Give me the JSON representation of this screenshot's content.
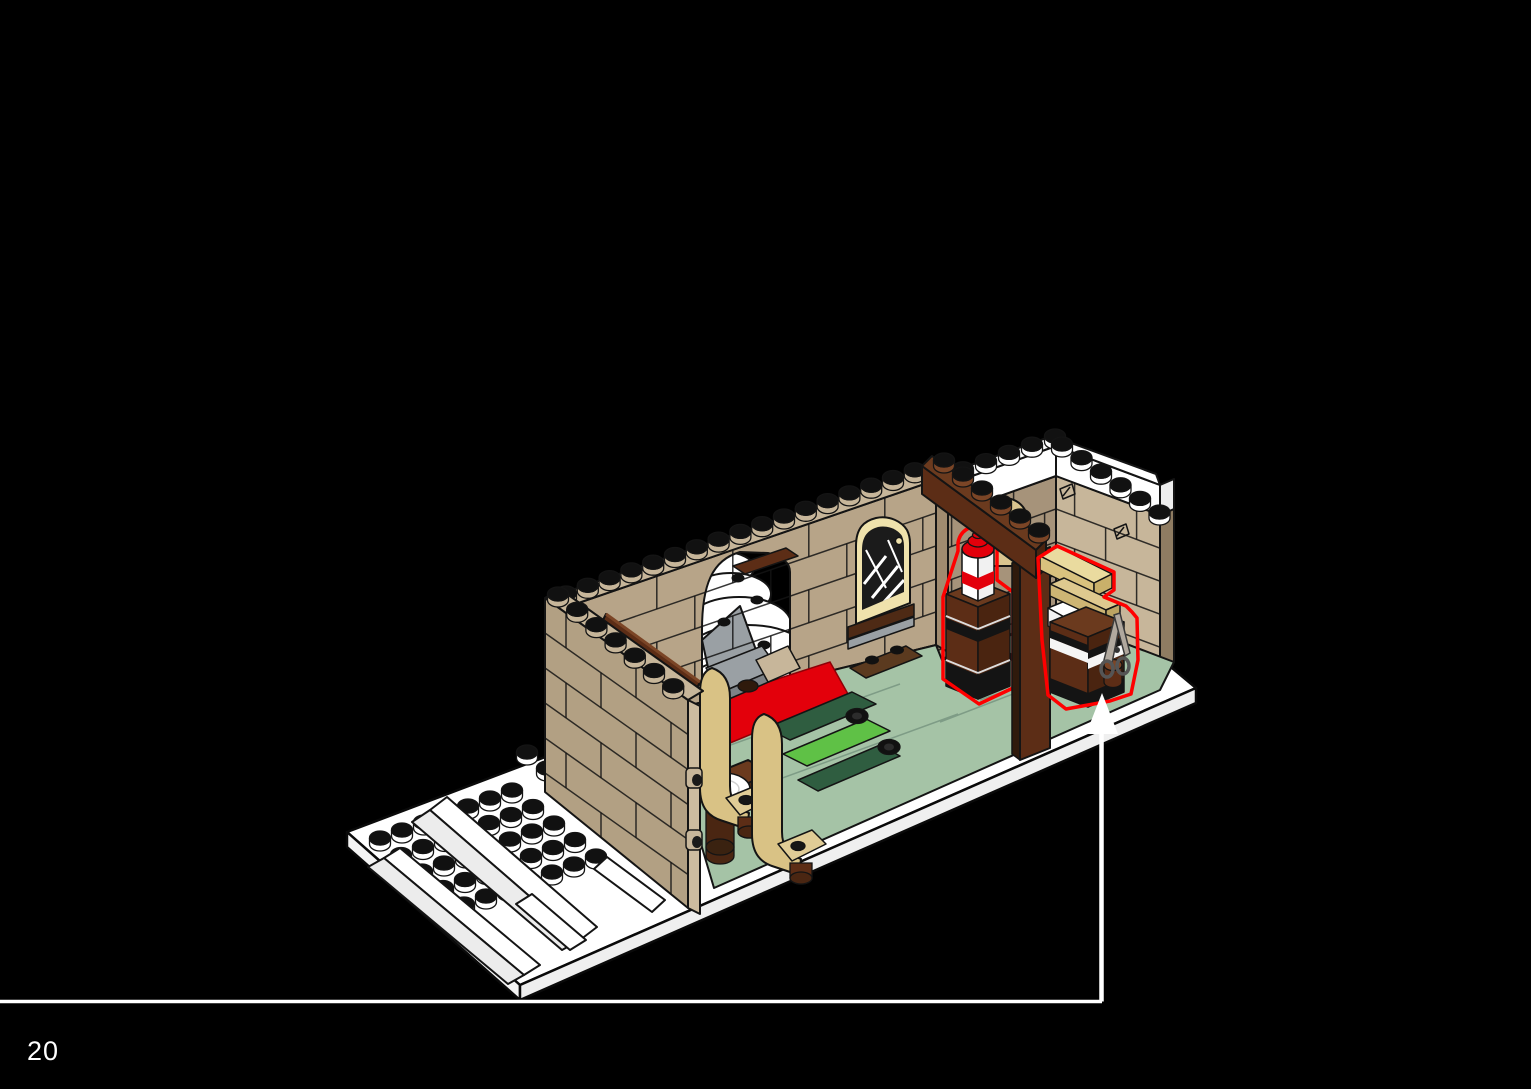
{
  "page": {
    "number": "20"
  },
  "footer": {
    "divider_color": "#ffffff"
  },
  "callout": {
    "arrow_color": "#ffffff",
    "highlight_color": "#ff0000",
    "points_to": "new-parts-cabinets"
  },
  "scene": {
    "kind": "lego-instruction-step",
    "subject": "room-interior-with-benches-table-and-cabinets",
    "highlighted_parts": [
      "cabinet-with-red-white-striped-tower",
      "cabinet-with-tan-plank-and-scissors"
    ]
  },
  "palette": {
    "background": "#000000",
    "baseplate": "#ffffff",
    "wall_tan": "#B7A488",
    "wall_tan_light": "#C7B69A",
    "wall_tan_dark": "#A08B6F",
    "masonry_cap": "#8F7C62",
    "window_frame": "#EFE2AC",
    "door_tan": "#D9C48F",
    "arch_brown": "#5C2D16",
    "arch_brown_light": "#6B3A1E",
    "cabinet_brown": "#5C2D16",
    "bench_tan": "#D9C285",
    "plank_tan": "#EADB9F",
    "floor_sand_green": "#A5C3A6",
    "floor_dark_green": "#2F5D40",
    "floor_bright_green": "#5FC146",
    "carpet_red": "#E3000B",
    "stripe_red": "#E3000B",
    "stair_gray": "#9AA0A4",
    "scissors_gray": "#B0A89E",
    "snow_white": "#ffffff"
  }
}
